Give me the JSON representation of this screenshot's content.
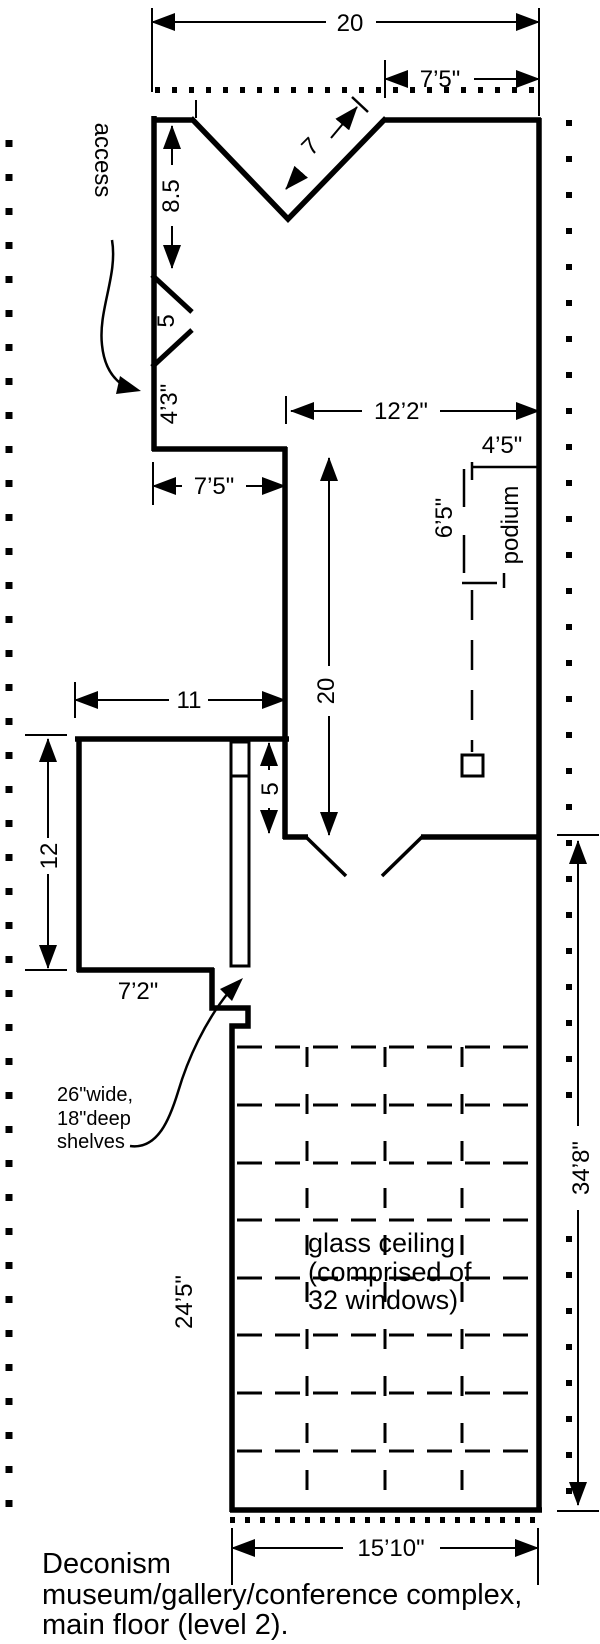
{
  "figure": {
    "caption": [
      "Deconism",
      "museum/gallery/conference complex,",
      "main floor (level 2)."
    ]
  },
  "labels": {
    "access": "access",
    "podium": "podium",
    "shelves": [
      "26\"wide,",
      "18\"deep",
      "shelves"
    ],
    "glass_ceiling": [
      "glass ceiling",
      "(comprised of",
      "32 windows)"
    ]
  },
  "dimensions": {
    "overall_top_width": "20",
    "top_right_offset": "7’5\"",
    "notch_side": "7",
    "wall_upper": "8.5",
    "access_width": "5",
    "wall_lower": "4’3\"",
    "hall_upper_width": "12’2\"",
    "alcove_width": "7’5\"",
    "hall_length": "20",
    "podium_from_wall": "4’5\"",
    "podium_length": "6’5\"",
    "storeroom_width": "11",
    "storeroom_height": "12",
    "passage_width": "5",
    "storeroom_bottom": "7’2\"",
    "glass_left_wall": "24’5\"",
    "right_overall": "34’8\"",
    "bottom_width": "15’10\""
  },
  "glass_grid": {
    "columns": 4,
    "rows": 8,
    "panes": 32
  },
  "colors": {
    "ink": "#000000",
    "paper": "#ffffff"
  }
}
